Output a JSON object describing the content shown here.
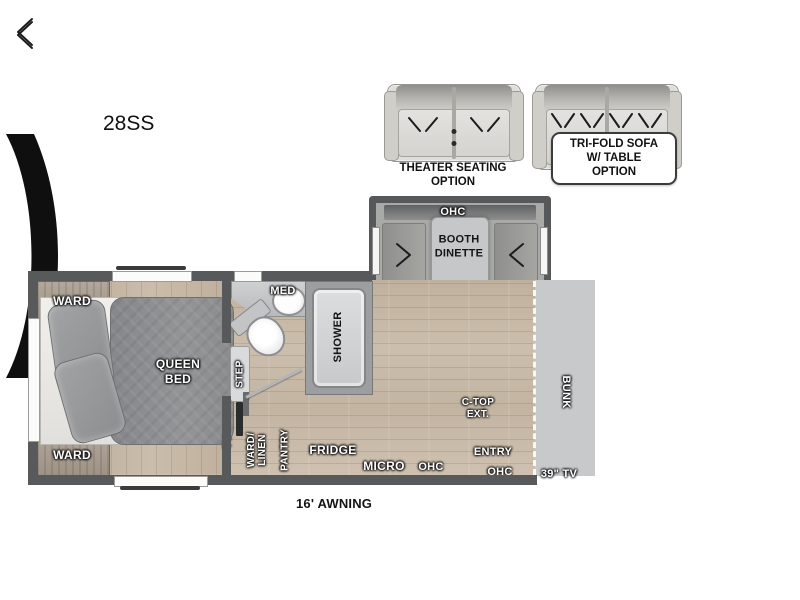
{
  "model_label": "28SS",
  "options": {
    "theater": {
      "line1": "THEATER SEATING",
      "line2": "OPTION"
    },
    "trifold": {
      "line1": "TRI-FOLD SOFA",
      "line2": "W/ TABLE",
      "line3": "OPTION"
    }
  },
  "slideout": {
    "ohc": "OHC",
    "dinette_line1": "BOOTH",
    "dinette_line2": "DINETTE"
  },
  "bedroom": {
    "ward_top": "WARD",
    "ward_bottom": "WARD",
    "bed_line1": "QUEEN",
    "bed_line2": "BED",
    "step": "STEP",
    "tv": "TV"
  },
  "bathroom": {
    "med": "MED",
    "shower": "SHOWER"
  },
  "kitchen": {
    "ward_linen_line1": "WARD/",
    "ward_linen_line2": "LINEN",
    "pantry": "PANTRY",
    "fridge": "FRIDGE",
    "micro": "MICRO",
    "ohc": "OHC",
    "ctop_line1": "C-TOP",
    "ctop_line2": "EXT.",
    "entry": "ENTRY",
    "ohc_entry": "OHC"
  },
  "front": {
    "bunk": "BUNK",
    "tv": "39\" TV"
  },
  "awning_label": "16' AWNING",
  "colors": {
    "wall": "#58595b",
    "floor": "#c8baa8",
    "cabinet": "#98999b",
    "bed": "#8e8f91",
    "stove": "#3a3234",
    "windshield": "#0f0f10",
    "cab_body": "#cfd0d2",
    "awning": "#b0b1b3",
    "label_dark": "#141414",
    "label_light": "#ffffff"
  }
}
